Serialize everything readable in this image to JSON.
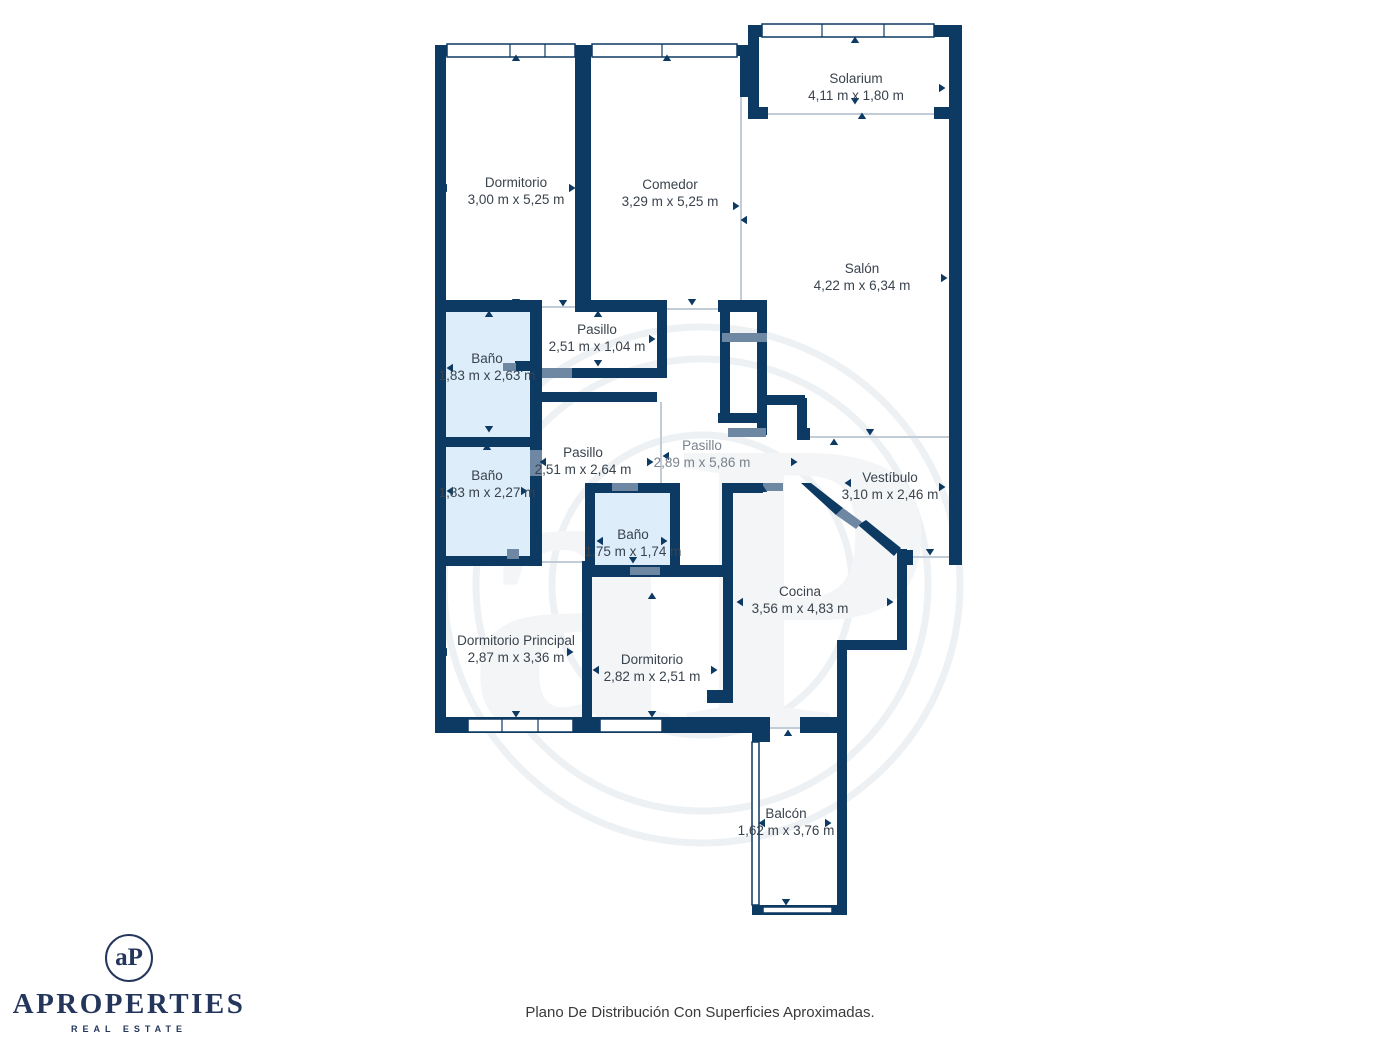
{
  "floorplan": {
    "rooms": [
      {
        "name": "Dormitorio",
        "dims": "3,00 m x 5,25 m"
      },
      {
        "name": "Comedor",
        "dims": "3,29 m x 5,25 m"
      },
      {
        "name": "Solarium",
        "dims": "4,11 m x 1,80 m"
      },
      {
        "name": "Salón",
        "dims": "4,22 m x 6,34 m"
      },
      {
        "name": "Pasillo",
        "dims": "2,51 m x 1,04 m"
      },
      {
        "name": "Baño",
        "dims": "1,83 m x 2,63 m"
      },
      {
        "name": "Baño",
        "dims": "1,83 m x 2,27 m"
      },
      {
        "name": "Pasillo",
        "dims": "2,51 m x 2,64 m"
      },
      {
        "name": "Pasillo",
        "dims": "2,89 m x 5,86 m"
      },
      {
        "name": "Vestíbulo",
        "dims": "3,10 m x 2,46 m"
      },
      {
        "name": "Baño",
        "dims": "1,75 m x 1,74 m"
      },
      {
        "name": "Cocina",
        "dims": "3,56 m x 4,83 m"
      },
      {
        "name": "Dormitorio Principal",
        "dims": "2,87 m x 3,36 m"
      },
      {
        "name": "Dormitorio",
        "dims": "2,82 m x 2,51 m"
      },
      {
        "name": "Balcón",
        "dims": "1,62 m x 3,76 m"
      }
    ],
    "colors": {
      "wall": "#0d3a62",
      "bathroom_fill": "#ddeefa",
      "door": "#6e87a3",
      "open_line": "#c2ccd6",
      "label_text": "#3a434d",
      "muted_label_text": "#79828c"
    }
  },
  "branding": {
    "monogram": "aP",
    "brand_name": "APROPERTIES",
    "brand_tagline": "REAL ESTATE",
    "brand_color": "#24365c"
  },
  "footer": {
    "caption": "Plano De Distribución Con Superficies Aproximadas."
  }
}
